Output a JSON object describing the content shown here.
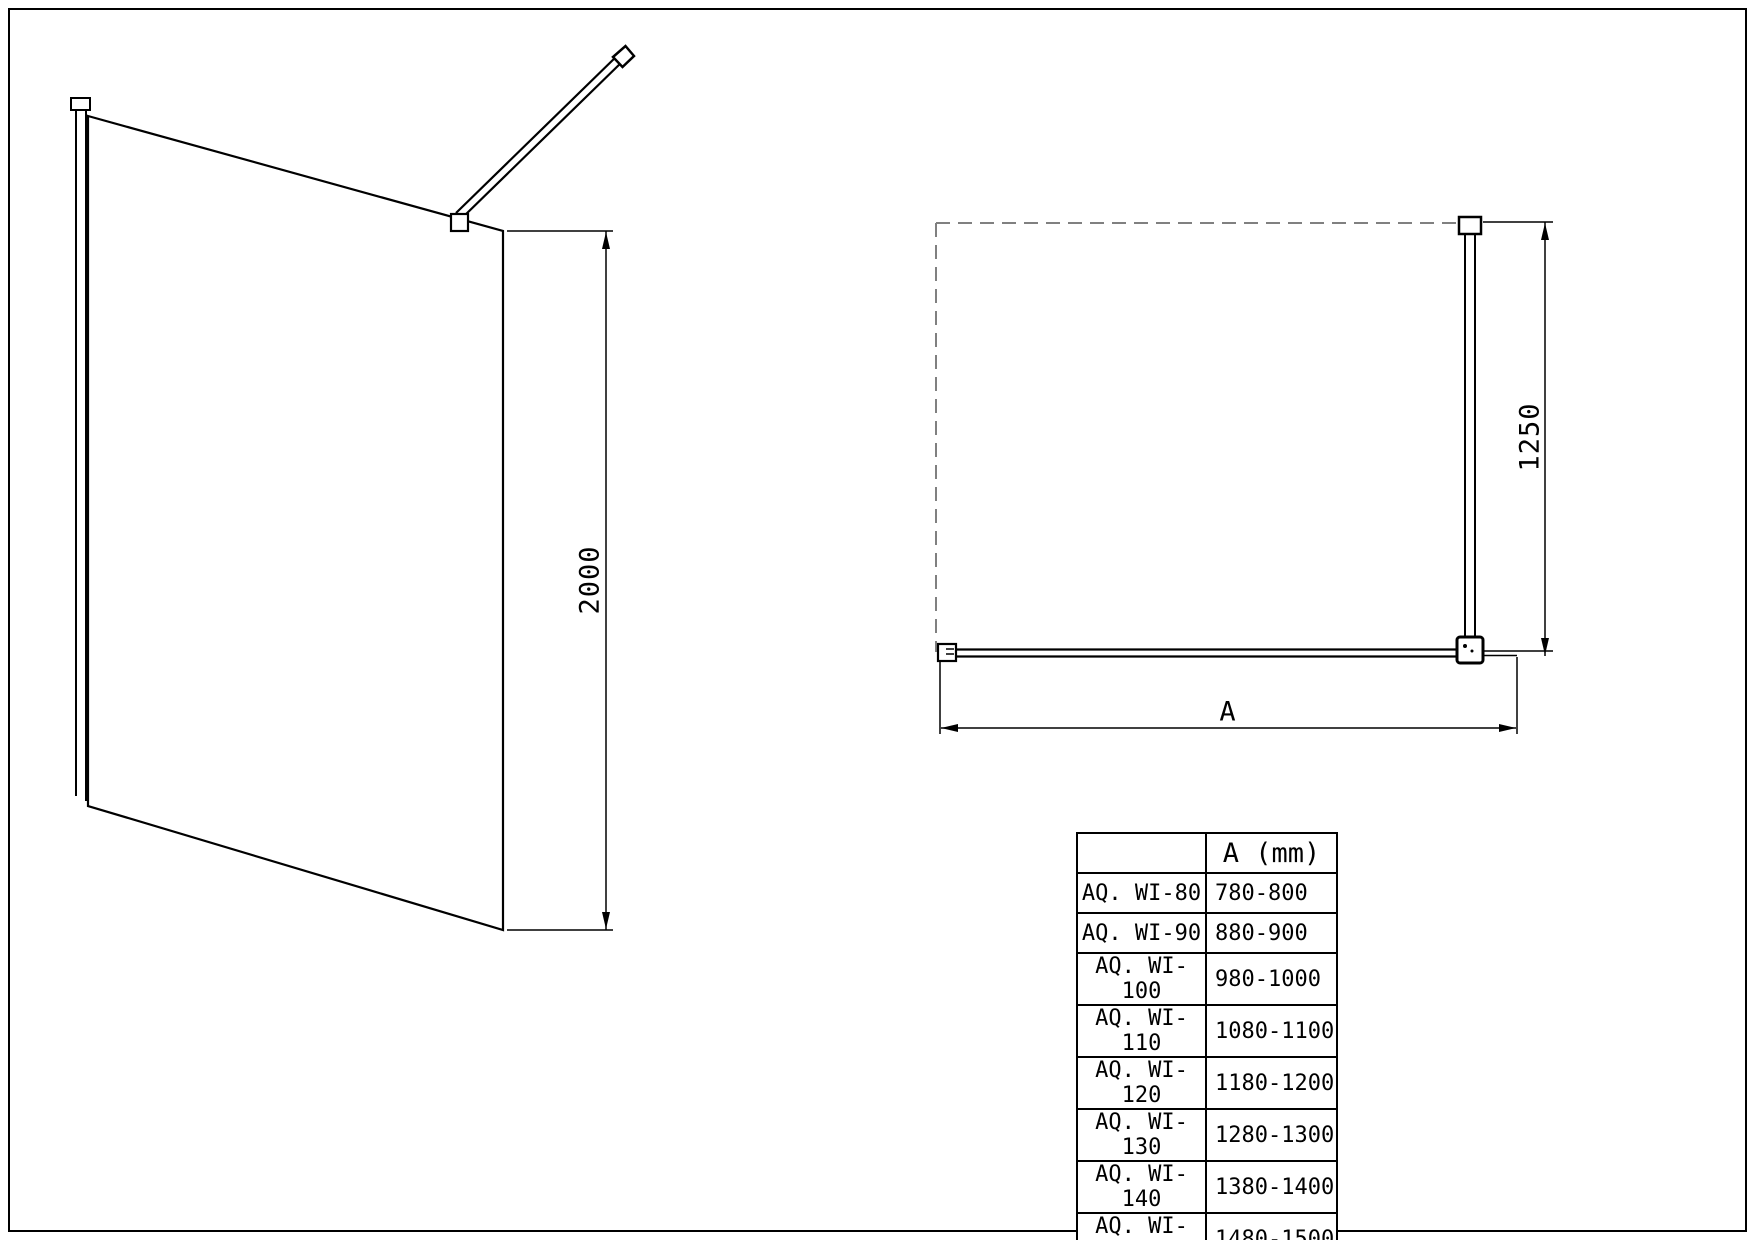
{
  "drawing": {
    "side_view": {
      "height_dim": "2000"
    },
    "top_view": {
      "depth_dim": "1250",
      "width_dim": "A"
    }
  },
  "table": {
    "header": {
      "model": "",
      "a_mm": "A (mm)"
    },
    "rows": [
      {
        "model": "AQ. WI-80",
        "a_mm": "780-800"
      },
      {
        "model": "AQ. WI-90",
        "a_mm": "880-900"
      },
      {
        "model": "AQ. WI-100",
        "a_mm": "980-1000"
      },
      {
        "model": "AQ. WI-110",
        "a_mm": "1080-1100"
      },
      {
        "model": "AQ. WI-120",
        "a_mm": "1180-1200"
      },
      {
        "model": "AQ. WI-130",
        "a_mm": "1280-1300"
      },
      {
        "model": "AQ. WI-140",
        "a_mm": "1380-1400"
      },
      {
        "model": "AQ. WI-150",
        "a_mm": "1480-1500"
      }
    ]
  }
}
